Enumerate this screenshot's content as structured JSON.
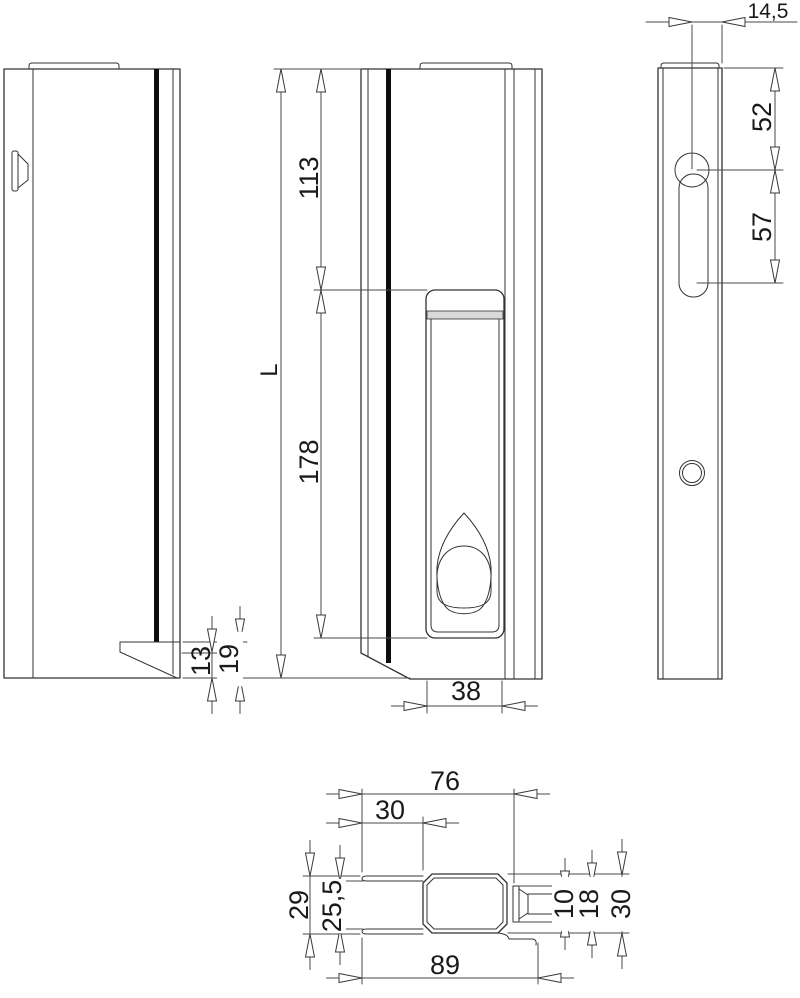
{
  "page": {
    "background": "#ffffff",
    "colors": {
      "geometry_line": "#333333",
      "dimension_line": "#4a4a4a",
      "profile_stripe": "#0d0d0d",
      "handle_band": "#d9d9d9"
    }
  },
  "drawing": {
    "dimensions": {
      "L": "L",
      "d113": "113",
      "d178": "178",
      "d38": "38",
      "d13": "13",
      "d19": "19",
      "d14_5": "14,5",
      "d52": "52",
      "d57": "57",
      "d76": "76",
      "d30_top": "30",
      "d29": "29",
      "d25_5": "25,5",
      "d89": "89",
      "d10": "10",
      "d18": "18",
      "d30_right": "30"
    }
  }
}
